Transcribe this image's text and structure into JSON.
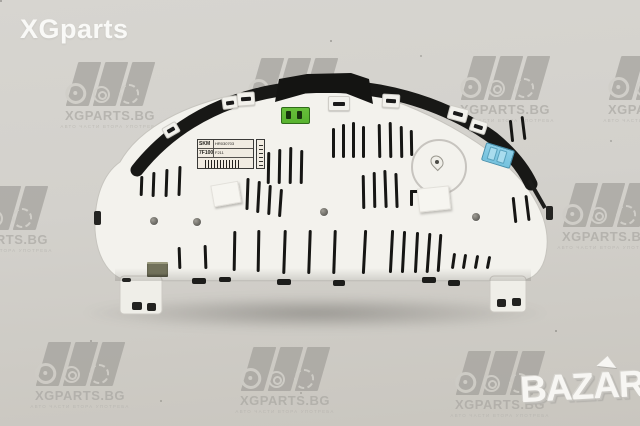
{
  "photo": {
    "background_top": "#d7d5d0",
    "background_bottom": "#c9c6bf"
  },
  "overlay": {
    "site_logo_text": "XGparts",
    "bazar_text": "BAZAR"
  },
  "watermark": {
    "brand": "XGPARTS.BG",
    "tagline": "АВТО ЧАСТИ ВТОРА УПОТРЕБА",
    "color": "#a5a39e",
    "tiles": [
      {
        "x": 55,
        "y": 62
      },
      {
        "x": 238,
        "y": 58
      },
      {
        "x": 450,
        "y": 56
      },
      {
        "x": 598,
        "y": 56
      },
      {
        "x": -52,
        "y": 186
      },
      {
        "x": 552,
        "y": 183
      },
      {
        "x": 25,
        "y": 342
      },
      {
        "x": 230,
        "y": 347
      },
      {
        "x": 445,
        "y": 351
      }
    ]
  },
  "product": {
    "type": "instrument cluster rear view",
    "sticker": {
      "cells": [
        [
          "SKM",
          "HR030703"
        ],
        [
          "7F100",
          "F211"
        ]
      ]
    },
    "connector_green": "#58b32f",
    "connector_blue": "#74c2de"
  }
}
